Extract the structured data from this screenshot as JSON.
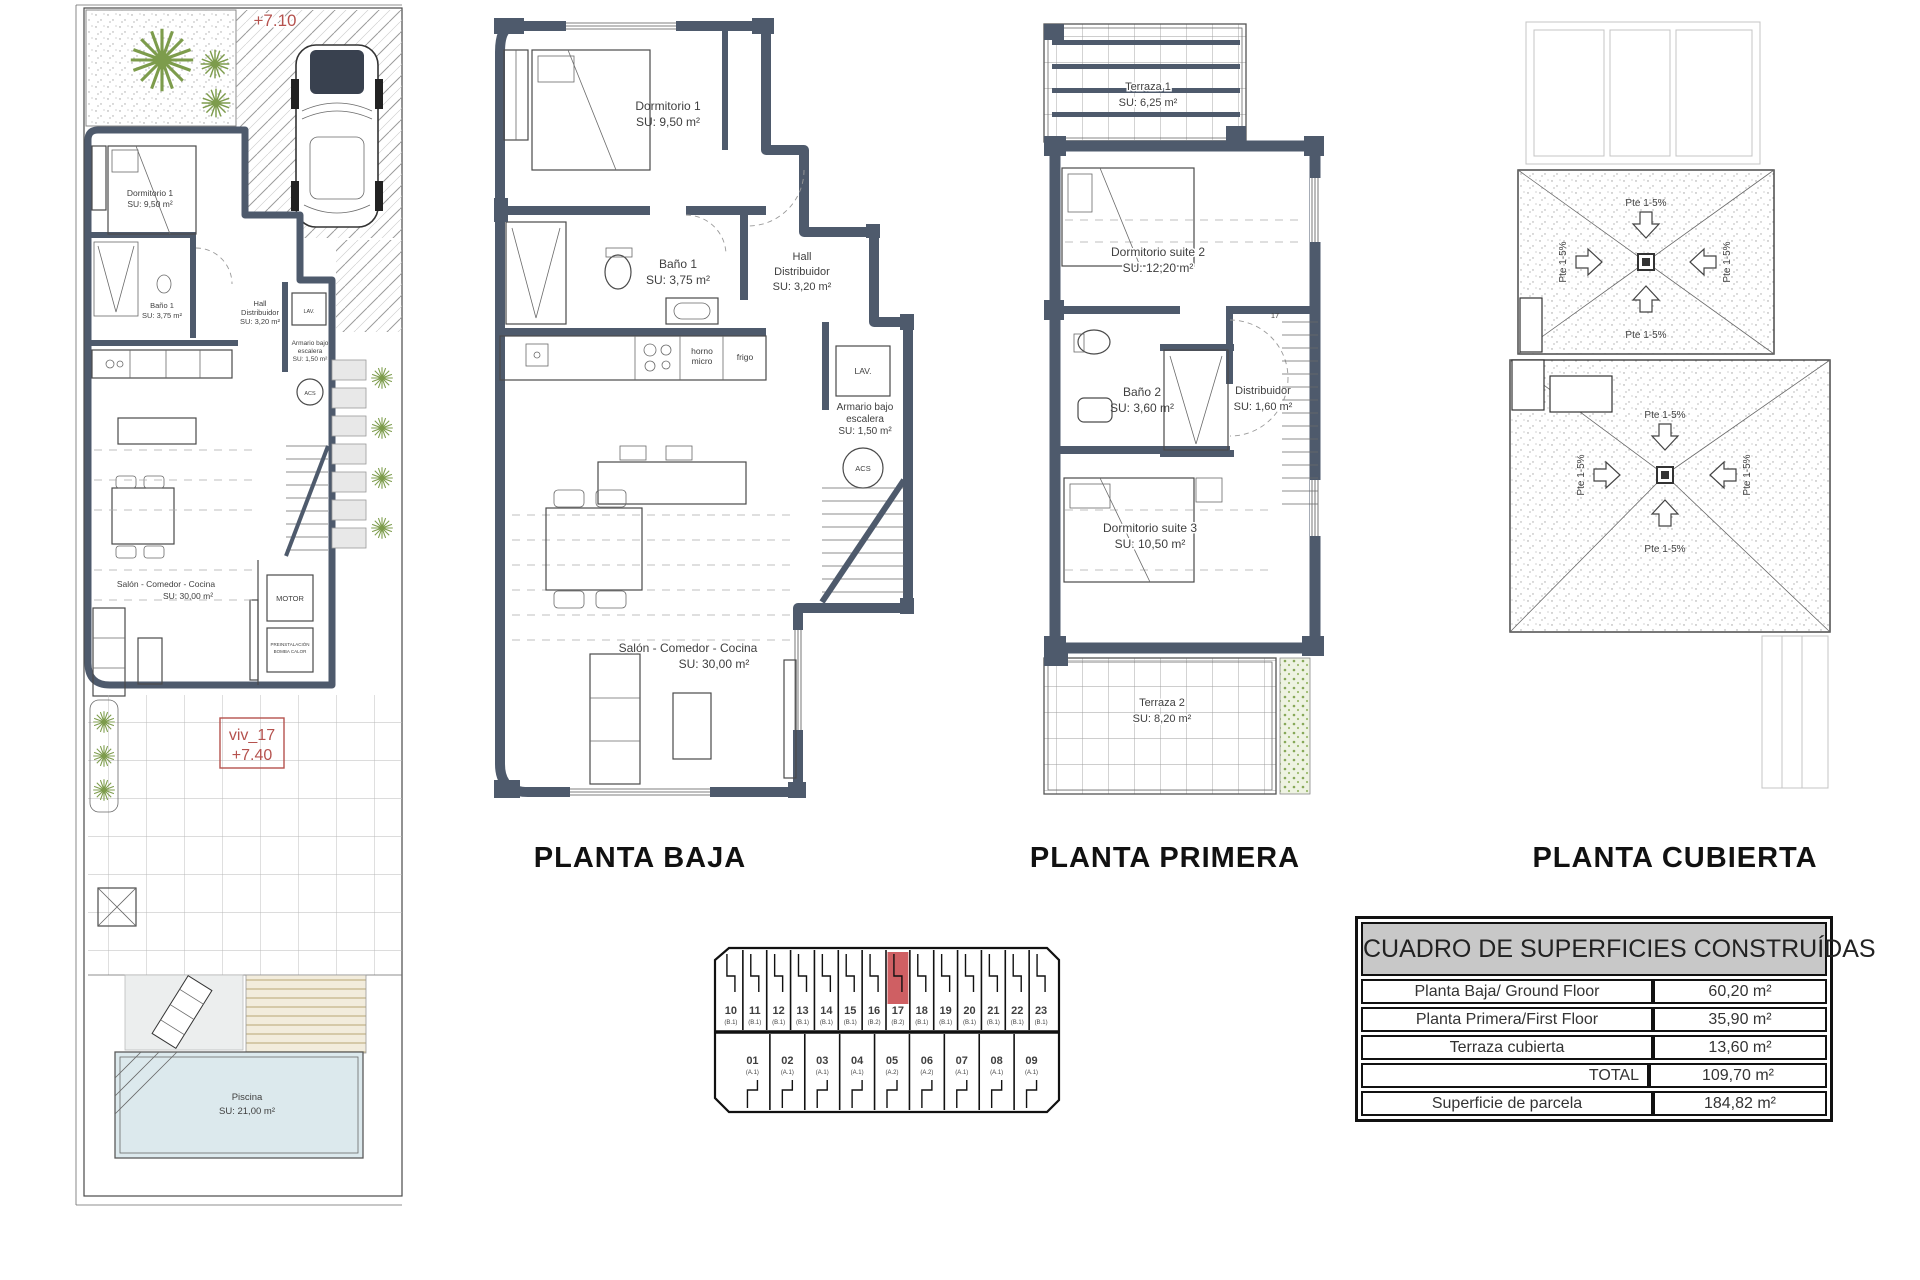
{
  "colors": {
    "wall": "#4e5a6c",
    "accent_red": "#b5524e",
    "unit_highlight": "#cf5f63",
    "pool_blue": "#dce9ed",
    "table_header_bg": "#c8c8c8",
    "plant_green": "#7d9c4c"
  },
  "titles": {
    "planta_baja": "PLANTA BAJA",
    "planta_primera": "PLANTA PRIMERA",
    "planta_cubierta": "PLANTA CUBIERTA"
  },
  "site_plan": {
    "level_label": "+7.10",
    "unit_tag": [
      "viv_17",
      "+7.40"
    ],
    "labels": {
      "dormitorio1": [
        "Dormitorio 1",
        "SU: 9,50 m²"
      ],
      "bano1": [
        "Baño 1",
        "SU: 3,75 m²"
      ],
      "hall": [
        "Hall",
        "Distribuidor",
        "SU: 3,20 m²"
      ],
      "armario": [
        "Armario bajo",
        "escalera",
        "SU: 1,50 m²"
      ],
      "lav": "LAV.",
      "acs": "ACS",
      "salon": [
        "Salón - Comedor - Cocina",
        "SU: 30,00 m²"
      ],
      "motor": "MOTOR",
      "preinst": [
        "PREINSTALACIÓN",
        "BOMBA CALOR"
      ],
      "piscina": [
        "Piscina",
        "SU: 21,00 m²"
      ]
    }
  },
  "planta_baja": {
    "labels": {
      "dormitorio1": [
        "Dormitorio 1",
        "SU: 9,50 m²"
      ],
      "bano1": [
        "Baño 1",
        "SU: 3,75 m²"
      ],
      "hall": [
        "Hall",
        "Distribuidor",
        "SU: 3,20 m²"
      ],
      "armario": [
        "Armario bajo",
        "escalera",
        "SU: 1,50 m²"
      ],
      "lav": "LAV.",
      "acs": "ACS",
      "horno": [
        "horno",
        "micro"
      ],
      "frigo": "frigo",
      "salon": [
        "Salón - Comedor - Cocina",
        "SU: 30,00 m²"
      ]
    }
  },
  "planta_primera": {
    "labels": {
      "terraza1": [
        "Terraza 1",
        "SU: 6,25 m²"
      ],
      "suite2": [
        "Dormitorio suite 2",
        "SU: 12,20 m²"
      ],
      "bano2": [
        "Baño 2",
        "SU: 3,60 m²"
      ],
      "distribuidor": [
        "Distribuidor",
        "SU: 1,60 m²"
      ],
      "suite3": [
        "Dormitorio suite 3",
        "SU: 10,50 m²"
      ],
      "terraza2": [
        "Terraza 2",
        "SU: 8,20 m²"
      ],
      "stair_ref": "17"
    }
  },
  "planta_cubierta": {
    "slope_label": "Pte 1-5%"
  },
  "keyplan": {
    "top_units": [
      {
        "num": "10",
        "type": "(B.1)"
      },
      {
        "num": "11",
        "type": "(B.1)"
      },
      {
        "num": "12",
        "type": "(B.1)"
      },
      {
        "num": "13",
        "type": "(B.1)"
      },
      {
        "num": "14",
        "type": "(B.1)"
      },
      {
        "num": "15",
        "type": "(B.1)"
      },
      {
        "num": "16",
        "type": "(B.2)"
      },
      {
        "num": "17",
        "type": "(B.2)",
        "hl": true
      },
      {
        "num": "18",
        "type": "(B.1)"
      },
      {
        "num": "19",
        "type": "(B.1)"
      },
      {
        "num": "20",
        "type": "(B.1)"
      },
      {
        "num": "21",
        "type": "(B.1)"
      },
      {
        "num": "22",
        "type": "(B.1)"
      },
      {
        "num": "23",
        "type": "(B.1)"
      }
    ],
    "bottom_units": [
      {
        "num": "01",
        "type": "(A.1)"
      },
      {
        "num": "02",
        "type": "(A.1)"
      },
      {
        "num": "03",
        "type": "(A.1)"
      },
      {
        "num": "04",
        "type": "(A.1)"
      },
      {
        "num": "05",
        "type": "(A.2)"
      },
      {
        "num": "06",
        "type": "(A.2)"
      },
      {
        "num": "07",
        "type": "(A.1)"
      },
      {
        "num": "08",
        "type": "(A.1)"
      },
      {
        "num": "09",
        "type": "(A.1)"
      }
    ]
  },
  "surfaces_table": {
    "title": "CUADRO DE SUPERFICIES CONSTRUÍDAS",
    "rows": [
      {
        "label": "Planta Baja/ Ground Floor",
        "value": "60,20 m²"
      },
      {
        "label": "Planta Primera/First Floor",
        "value": "35,90 m²"
      },
      {
        "label": "Terraza cubierta",
        "value": "13,60 m²"
      },
      {
        "label": "TOTAL",
        "value": "109,70 m²",
        "total": true
      },
      {
        "label": "Superficie de parcela",
        "value": "184,82 m²"
      }
    ]
  }
}
